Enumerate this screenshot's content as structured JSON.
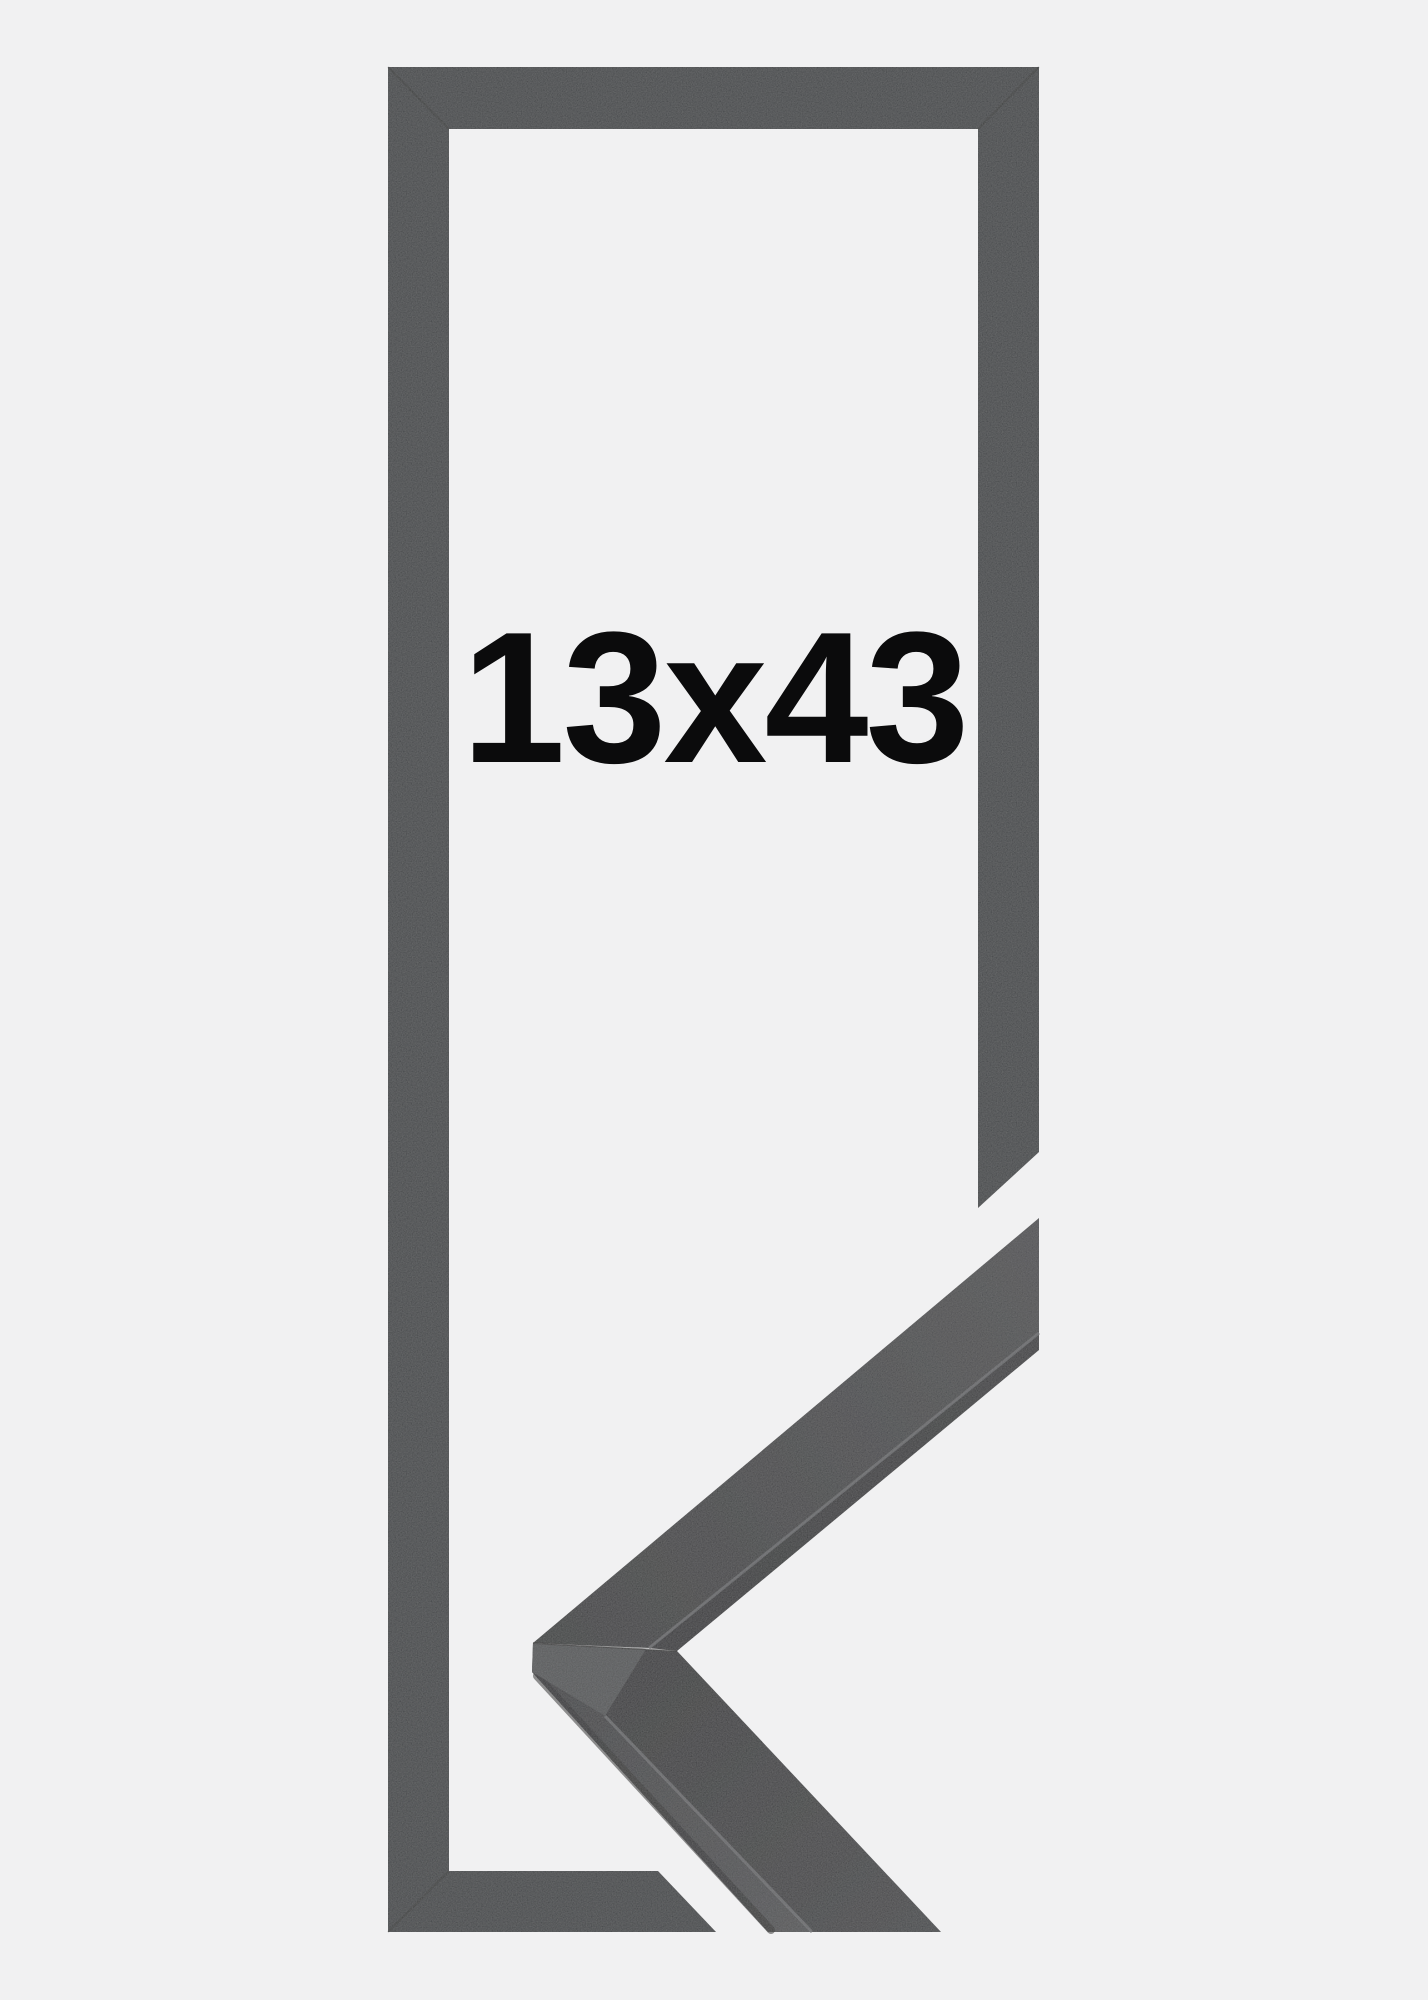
{
  "image": {
    "size_label": "13x43",
    "description": "black picture frame, front view with 3D mitred corner sample"
  },
  "colors": {
    "background": "#f1f1f2",
    "frame": "#333437",
    "label_text": "#0b0b0c",
    "miter_shadow": "rgba(0,0,0,0.28)",
    "cut_face": "#4a4b4e",
    "seam_highlight": "#67686b",
    "edge_shadow": "rgba(16,17,19,0.6)",
    "miter_seam_dark": "rgba(10,10,12,0.45)",
    "upper_front_near": "#2c2d2f",
    "upper_front_far": "#404144",
    "upper_side_near": "#202124",
    "upper_side_far": "#2b2c2f",
    "lower_top_near": "#27282a",
    "lower_top_far": "#36373a",
    "lower_front_near": "#323336",
    "lower_front_far": "#47484b"
  }
}
